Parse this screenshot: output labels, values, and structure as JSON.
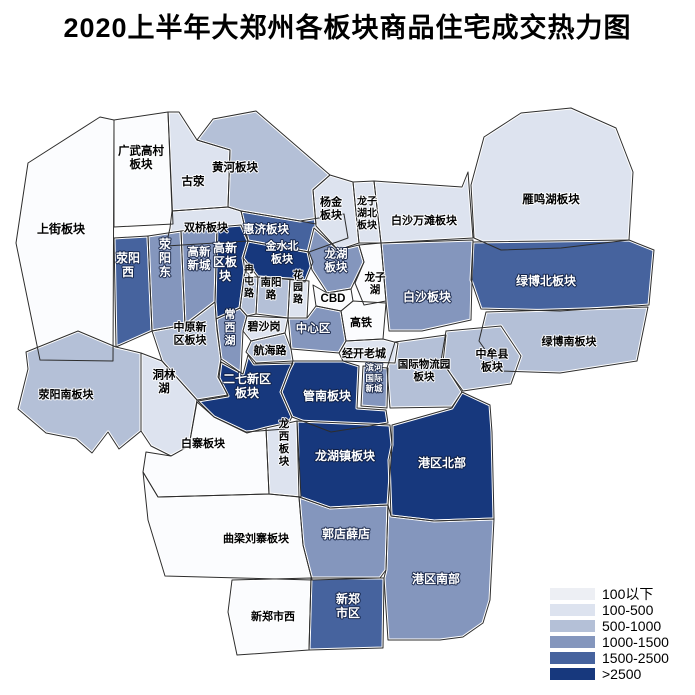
{
  "title": "2020上半年大郑州各板块商品住宅成交热力图",
  "legend": {
    "items": [
      {
        "label": "100以下",
        "color": "#edeff4",
        "map_color": "#fbfcfe"
      },
      {
        "label": "100-500",
        "color": "#dde3ef"
      },
      {
        "label": "500-1000",
        "color": "#b4c0d7"
      },
      {
        "label": "1000-1500",
        "color": "#8496bd"
      },
      {
        "label": "1500-2500",
        "color": "#46639e"
      },
      {
        "label": ">2500",
        "color": "#17387d"
      }
    ]
  },
  "map": {
    "outline_color": "#2d2d2d",
    "halo_color": "#ffffff",
    "regions": [
      {
        "name": "上街板块",
        "category": "100以下",
        "points": "100,117 114,120 113,361 40,360 16,243 28,163",
        "label": {
          "x": 61,
          "y": 229,
          "lines": [
            "上街板块"
          ],
          "size": 12
        }
      },
      {
        "name": "广武高村板块",
        "category": "100以下",
        "points": "114,120 168,112 173,224 114,227",
        "label": {
          "x": 141,
          "y": 157,
          "lines": [
            "广武高村",
            "板块"
          ],
          "size": 11.5
        }
      },
      {
        "name": "古荥",
        "category": "100-500",
        "points": "168,112 179,112 197,140 230,150 228,207 172,211",
        "label": {
          "x": 193,
          "y": 181,
          "lines": [
            "古荥"
          ],
          "size": 11.5
        }
      },
      {
        "name": "黄河板块",
        "category": "500-1000",
        "points": "197,140 213,119 256,111 330,175 313,190 316,224 300,221 241,211 228,207 230,150",
        "label": {
          "x": 235,
          "y": 167,
          "lines": [
            "黄河板块"
          ],
          "size": 11.5
        }
      },
      {
        "name": "双桥板块",
        "category": "100-500",
        "points": "172,211 228,207 241,211 248,241 166,246 170,228",
        "label": {
          "x": 206,
          "y": 227,
          "lines": [
            "双桥板块"
          ],
          "size": 11
        }
      },
      {
        "name": "惠济板块",
        "category": "1500-2500",
        "points": "241,211 300,221 344,214 348,238 309,252 248,241",
        "label": {
          "x": 266,
          "y": 229,
          "lines": [
            "惠济板块"
          ],
          "size": 11.5
        }
      },
      {
        "name": "杨金板块",
        "category": "100-500",
        "points": "313,190 330,175 353,182 359,243 338,250 316,226",
        "label": {
          "x": 331,
          "y": 208,
          "lines": [
            "杨金",
            "板块"
          ],
          "size": 11
        }
      },
      {
        "name": "龙子湖北板块",
        "category": "100-500",
        "points": "353,182 374,181 381,243 359,243",
        "label": {
          "x": 367,
          "y": 213,
          "lines": [
            "龙子",
            "湖北",
            "板块"
          ],
          "size": 10
        }
      },
      {
        "name": "白沙万滩板块",
        "category": "100-500",
        "points": "374,181 462,187 468,172 473,238 381,243",
        "label": {
          "x": 424,
          "y": 220,
          "lines": [
            "白沙万滩板块"
          ],
          "size": 11
        }
      },
      {
        "name": "雁鸣湖板块",
        "category": "100-500",
        "points": "471,185 484,137 521,113 571,108 616,128 633,172 629,240 561,248 501,250 474,238",
        "label": {
          "x": 551,
          "y": 199,
          "lines": [
            "雁鸣湖板块"
          ],
          "size": 11.5
        }
      },
      {
        "name": "荥阳西",
        "category": "1500-2500",
        "points": "114,238 148,236 152,331 116,347",
        "label": {
          "x": 128,
          "y": 265,
          "lines": [
            "荥阳",
            "西"
          ],
          "size": 12
        }
      },
      {
        "name": "荥阳东",
        "category": "1000-1500",
        "points": "148,236 181,231 185,325 152,331",
        "label": {
          "x": 165,
          "y": 258,
          "lines": [
            "荥",
            "阳",
            "东"
          ],
          "size": 12
        }
      },
      {
        "name": "高新新城",
        "category": "1000-1500",
        "points": "181,231 217,227 215,302 185,325",
        "label": {
          "x": 199,
          "y": 258,
          "lines": [
            "高新",
            "新城"
          ],
          "size": 11.5
        }
      },
      {
        "name": "高新区板块",
        "category": ">2500",
        "points": "217,227 241,225 248,241 243,258 245,270 240,308 216,319 215,302",
        "label": {
          "x": 225,
          "y": 262,
          "lines": [
            "高新",
            "区板",
            "块"
          ],
          "size": 12
        }
      },
      {
        "name": "金水北板块",
        "category": ">2500",
        "points": "248,241 309,252 313,262 305,282 295,280 258,277 243,258",
        "label": {
          "x": 282,
          "y": 252,
          "lines": [
            "金水北",
            "板块"
          ],
          "size": 11
        }
      },
      {
        "name": "龙湖板块",
        "category": "1000-1500",
        "points": "314,228 338,250 359,245 364,262 351,289 327,293 312,270 308,252",
        "label": {
          "x": 336,
          "y": 260,
          "lines": [
            "龙湖",
            "板块"
          ],
          "size": 11.5
        }
      },
      {
        "name": "龙子湖",
        "category": "100以下",
        "points": "359,245 381,243 386,301 364,305 355,283 364,262",
        "label": {
          "x": 375,
          "y": 283,
          "lines": [
            "龙子",
            "湖"
          ],
          "size": 10.5
        }
      },
      {
        "name": "白沙板块",
        "category": "1000-1500",
        "points": "381,243 473,240 471,320 422,331 389,331 386,301",
        "label": {
          "x": 427,
          "y": 297,
          "lines": [
            "白沙板块"
          ],
          "size": 12
        }
      },
      {
        "name": "绿博北板块",
        "category": "1500-2500",
        "points": "473,242 629,240 654,250 649,305 560,311 481,309 471,280",
        "label": {
          "x": 546,
          "y": 281,
          "lines": [
            "绿博北板块"
          ],
          "size": 12
        }
      },
      {
        "name": "绿博南板块",
        "category": "500-1000",
        "points": "486,312 648,307 637,361 560,373 500,371 479,341",
        "label": {
          "x": 569,
          "y": 341,
          "lines": [
            "绿博南板块"
          ],
          "size": 11
        }
      },
      {
        "name": "中牟县板块",
        "category": "500-1000",
        "points": "446,331 501,326 521,356 511,384 463,391 441,361",
        "label": {
          "x": 492,
          "y": 360,
          "lines": [
            "中牟县",
            "板块"
          ],
          "size": 11
        }
      },
      {
        "name": "国际物流园板块",
        "category": "500-1000",
        "points": "395,342 446,335 443,362 462,392 452,407 390,408 387,368",
        "label": {
          "x": 424,
          "y": 370,
          "lines": [
            "国际物流园",
            "板块"
          ],
          "size": 10.5
        }
      },
      {
        "name": "南阳路",
        "category": "500-1000",
        "points": "258,277 290,279 288,318 256,314",
        "label": {
          "x": 271,
          "y": 288,
          "lines": [
            "南阳",
            "路"
          ],
          "size": 10.5
        }
      },
      {
        "name": "花园路",
        "category": "100-500",
        "points": "290,279 309,281 307,318 288,318",
        "label": {
          "x": 298,
          "y": 287,
          "lines": [
            "花",
            "园",
            "路"
          ],
          "size": 10
        }
      },
      {
        "name": "CBD",
        "category": "100以下",
        "points": "313,285 327,293 351,289 353,301 341,311 316,306",
        "label": {
          "x": 333,
          "y": 298,
          "lines": [
            "CBD"
          ],
          "size": 11.5
        }
      },
      {
        "name": "高铁",
        "category": "100以下",
        "points": "353,301 386,303 383,339 346,341 341,311",
        "label": {
          "x": 361,
          "y": 322,
          "lines": [
            "高铁"
          ],
          "size": 11
        }
      },
      {
        "name": "中心区",
        "category": "1000-1500",
        "points": "288,318 307,318 316,306 341,311 346,341 339,353 291,349",
        "label": {
          "x": 313,
          "y": 328,
          "lines": [
            "中心区"
          ],
          "size": 11.5
        }
      },
      {
        "name": "碧沙岗",
        "category": "100-500",
        "points": "247,316 288,318 285,333 251,341 243,331",
        "label": {
          "x": 264,
          "y": 326,
          "lines": [
            "碧沙岗"
          ],
          "size": 11
        }
      },
      {
        "name": "冉屯路",
        "category": "500-1000",
        "points": "245,270 251,277 258,277 256,314 247,316 240,308",
        "label": {
          "x": 249,
          "y": 281,
          "lines": [
            "冉",
            "屯",
            "路"
          ],
          "size": 10
        }
      },
      {
        "name": "常西湖",
        "category": "1000-1500",
        "points": "216,319 240,308 247,316 243,331 241,373 221,359",
        "label": {
          "x": 230,
          "y": 327,
          "lines": [
            "常",
            "西",
            "湖"
          ],
          "size": 11
        }
      },
      {
        "name": "航海路",
        "category": "500-1000",
        "points": "251,341 285,333 291,349 293,361 256,363 246,352",
        "label": {
          "x": 270,
          "y": 350,
          "lines": [
            "航海路"
          ],
          "size": 11
        }
      },
      {
        "name": "经开老城",
        "category": "100-500",
        "points": "346,341 383,339 398,343 395,363 343,361 339,353",
        "label": {
          "x": 364,
          "y": 353,
          "lines": [
            "经开老城"
          ],
          "size": 11
        }
      },
      {
        "name": "滨河国际新城",
        "category": "1000-1500",
        "points": "363,366 388,368 387,408 361,406",
        "label": {
          "x": 374,
          "y": 378,
          "lines": [
            "滨河",
            "国际",
            "新城"
          ],
          "size": 8.5
        }
      },
      {
        "name": "管南板块",
        "category": ">2500",
        "points": "293,361 343,361 359,366 357,408 386,410 388,423 331,432 292,417 281,392 289,371",
        "label": {
          "x": 327,
          "y": 396,
          "lines": [
            "管南板块"
          ],
          "size": 12
        }
      },
      {
        "name": "中原新区板块",
        "category": "500-1000",
        "points": "152,331 185,325 215,302 217,330 221,359 218,377 228,395 197,400 162,361",
        "label": {
          "x": 190,
          "y": 333,
          "lines": [
            "中原新",
            "区板块"
          ],
          "size": 11
        }
      },
      {
        "name": "洞林湖",
        "category": "100-500",
        "points": "141,353 162,361 197,400 189,446 171,456 151,446 141,431",
        "label": {
          "x": 164,
          "y": 381,
          "lines": [
            "洞林",
            "湖"
          ],
          "size": 11.5
        }
      },
      {
        "name": "荥阳南板块",
        "category": "500-1000",
        "points": "26,352 78,331 116,347 141,353 141,431 119,449 108,432 92,453 76,439 46,433 18,409 28,369",
        "label": {
          "x": 66,
          "y": 394,
          "lines": [
            "荥阳南板块"
          ],
          "size": 11
        }
      },
      {
        "name": "二七新区板块",
        "category": ">2500",
        "points": "219,378 221,362 243,374 248,355 254,364 293,363 289,371 281,392 292,417 285,429 246,432 214,417 198,401 228,396",
        "label": {
          "x": 247,
          "y": 386,
          "lines": [
            "二七新区",
            "板块"
          ],
          "size": 12
        }
      },
      {
        "name": "白寨板块",
        "category": "100以下",
        "points": "146,452 171,456 189,446 197,402 214,417 247,433 266,428 269,494 158,497 143,472",
        "label": {
          "x": 203,
          "y": 443,
          "lines": [
            "白寨板块"
          ],
          "size": 11
        }
      },
      {
        "name": "龙西板块",
        "category": "100-500",
        "points": "266,428 297,421 301,497 269,494",
        "label": {
          "x": 284,
          "y": 442,
          "lines": [
            "龙",
            "西",
            "板",
            "块"
          ],
          "size": 10.5
        }
      },
      {
        "name": "龙湖镇板块",
        "category": ">2500",
        "points": "297,421 390,425 392,445 388,505 330,508 299,497",
        "label": {
          "x": 345,
          "y": 456,
          "lines": [
            "龙湖镇板块"
          ],
          "size": 12
        }
      },
      {
        "name": "港区北部",
        "category": ">2500",
        "points": "392,425 452,408 462,392 490,405 492,432 494,519 434,521 391,516 389,460 392,445",
        "label": {
          "x": 442,
          "y": 463,
          "lines": [
            "港区北部"
          ],
          "size": 12
        }
      },
      {
        "name": "郭店薛店",
        "category": "1000-1500",
        "points": "299,497 330,508 388,505 386,570 380,578 312,580 303,545",
        "label": {
          "x": 346,
          "y": 534,
          "lines": [
            "郭店薛店"
          ],
          "size": 12
        }
      },
      {
        "name": "港区南部",
        "category": "1000-1500",
        "points": "388,505 391,516 434,521 494,519 490,600 483,623 463,637 440,640 388,640 384,578 386,570",
        "label": {
          "x": 436,
          "y": 579,
          "lines": [
            "港区南部"
          ],
          "size": 12
        }
      },
      {
        "name": "曲梁刘寨板块",
        "category": "100以下",
        "points": "143,472 158,497 269,494 299,497 303,545 312,580 240,578 165,576 148,520",
        "label": {
          "x": 256,
          "y": 538,
          "lines": [
            "曲梁刘寨板块"
          ],
          "size": 11
        }
      },
      {
        "name": "新郑市西",
        "category": "100以下",
        "points": "232,580 311,578 309,650 237,655 228,612",
        "label": {
          "x": 273,
          "y": 616,
          "lines": [
            "新郑市西"
          ],
          "size": 11
        }
      },
      {
        "name": "新郑市区",
        "category": "1500-2500",
        "points": "311,578 380,578 384,578 383,648 309,650",
        "label": {
          "x": 348,
          "y": 606,
          "lines": [
            "新郑",
            "市区"
          ],
          "size": 12
        }
      }
    ]
  }
}
